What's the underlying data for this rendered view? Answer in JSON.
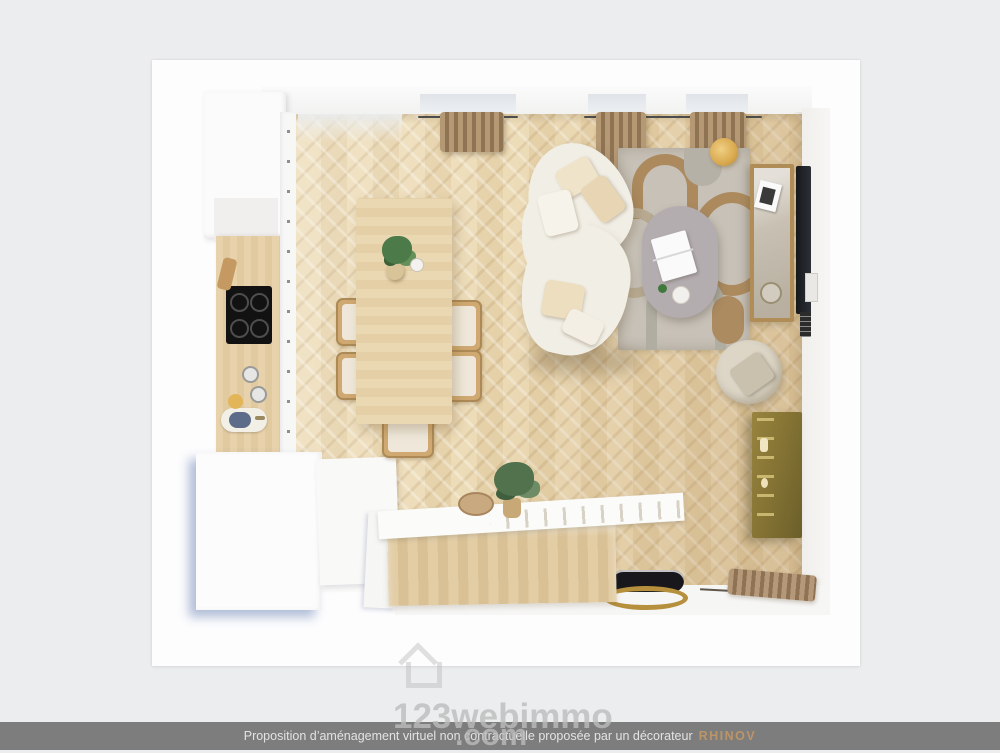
{
  "scene": {
    "type": "top-down-3d-floorplan-render",
    "colors": {
      "background": "#ecedee",
      "canvas": "#fdfdfe",
      "floor_light": "#eddcb8",
      "floor_dark": "#d9c095",
      "rug_base": "#c7c1b7",
      "rug_accent": "#ac8a5e",
      "sofa": "#f1eee5",
      "curtain": "#a98c68",
      "brass_shelf": "#857434",
      "gold_lamp": "#d9a94e"
    },
    "room": {
      "furniture": [
        "kitchen-tall-cabinet",
        "kitchen-counter",
        "induction-cooktop",
        "kitchen-sink",
        "dining-table",
        "dining-chairs",
        "table-plant",
        "curved-sofa",
        "sofa-cushions",
        "area-rug",
        "coffee-table",
        "laptop",
        "floor-lamp",
        "tv-console",
        "wall-tv",
        "armchair",
        "brass-shelf",
        "kitchen-island",
        "island-plant",
        "window-curtains"
      ]
    }
  },
  "watermark": {
    "name": "123webimmo",
    "tld": ".com",
    "icon": "house-icon"
  },
  "caption": {
    "text": "Proposition d’aménagement virtuel non contractuelle proposée par un décorateur",
    "brand": "RHINOV",
    "bar_color": "#7d7d7d",
    "text_color": "#e3e3e3",
    "brand_color": "#bb9567"
  }
}
